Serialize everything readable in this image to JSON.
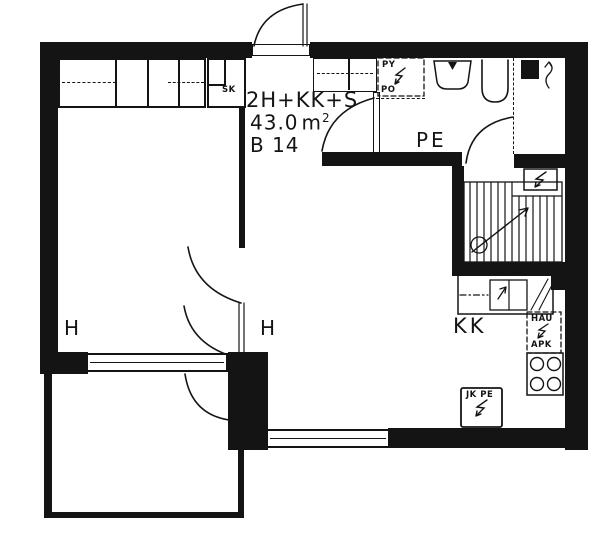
{
  "colors": {
    "ink": "#141414",
    "paper": "#ffffff"
  },
  "info": {
    "type_label": "2H+KK+S",
    "area_number": "43.0",
    "area_unit": "m",
    "area_exp": "2",
    "unit_id": "B 14"
  },
  "rooms": {
    "bedroom_label": "H",
    "living_label": "H",
    "kitchen_label": "KK",
    "bathroom_label": "PE"
  },
  "annotations": {
    "cleaning_closet": "SK",
    "washing_machine_top": "PY",
    "washing_machine_bottom": "PO",
    "appliance_reservation_top": "HAU",
    "appliance_reservation_bottom": "APK",
    "fridge_freezer": "JK PE"
  }
}
